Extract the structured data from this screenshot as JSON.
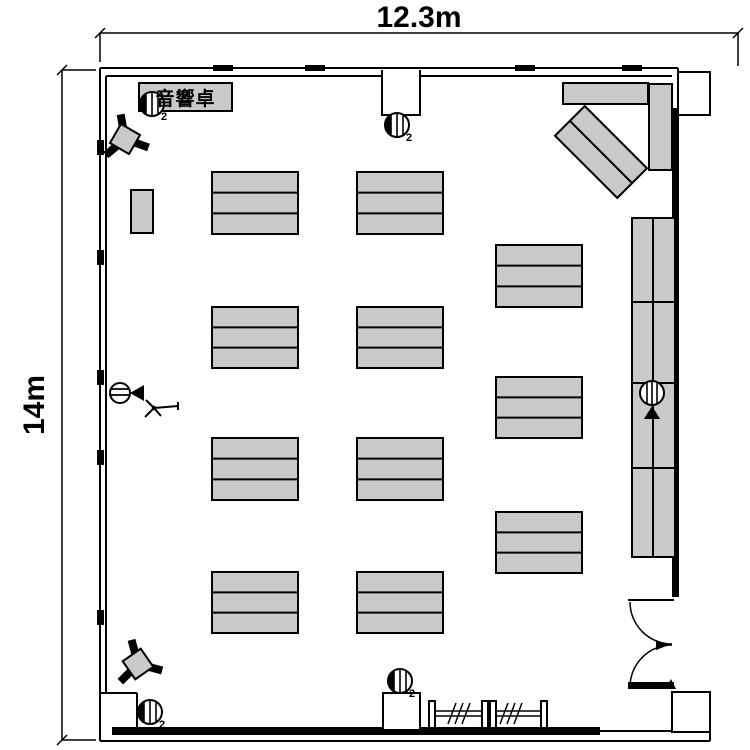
{
  "dimensions": {
    "width_label": "12.3m",
    "height_label": "14m"
  },
  "labels": {
    "audio_console": "音響卓"
  },
  "colors": {
    "table_fill": "#c9c9c9",
    "wall": "#000000",
    "background": "#ffffff"
  },
  "furniture": {
    "fill": "#c9c9c9",
    "stroke": "#000000",
    "table_groups": [
      {
        "x": 212,
        "y": 172,
        "w": 86,
        "h": 62,
        "rows": 3
      },
      {
        "x": 212,
        "y": 307,
        "w": 86,
        "h": 61,
        "rows": 3
      },
      {
        "x": 212,
        "y": 438,
        "w": 86,
        "h": 62,
        "rows": 3
      },
      {
        "x": 212,
        "y": 572,
        "w": 86,
        "h": 61,
        "rows": 3
      },
      {
        "x": 357,
        "y": 172,
        "w": 86,
        "h": 62,
        "rows": 3
      },
      {
        "x": 357,
        "y": 307,
        "w": 86,
        "h": 61,
        "rows": 3
      },
      {
        "x": 357,
        "y": 438,
        "w": 86,
        "h": 62,
        "rows": 3
      },
      {
        "x": 357,
        "y": 572,
        "w": 86,
        "h": 61,
        "rows": 3
      },
      {
        "x": 496,
        "y": 245,
        "w": 86,
        "h": 62,
        "rows": 3
      },
      {
        "x": 496,
        "y": 377,
        "w": 86,
        "h": 61,
        "rows": 3
      },
      {
        "x": 496,
        "y": 512,
        "w": 86,
        "h": 61,
        "rows": 3
      },
      {
        "x": 563,
        "y": 83,
        "w": 85,
        "h": 21,
        "rows": 1
      },
      {
        "x": 649,
        "y": 84,
        "w": 23,
        "h": 86,
        "rows": 1
      },
      {
        "x": 131,
        "y": 190,
        "w": 22,
        "h": 43,
        "rows": 1
      },
      {
        "x": 139,
        "y": 83,
        "w": 93,
        "h": 28,
        "rows": 1
      }
    ],
    "rotated_group": {
      "cx": 601,
      "cy": 152,
      "w": 88,
      "h": 42,
      "angle": 45,
      "rows": 2
    },
    "right_strip": {
      "x": 632,
      "y": 218,
      "w": 43,
      "h": 339,
      "col_divider": 21,
      "row_dividers": [
        84,
        165,
        250
      ]
    }
  },
  "symbols": [
    {
      "name": "speaker-icon",
      "type": "speaker",
      "x": 152,
      "y": 104,
      "label": "2"
    },
    {
      "name": "speaker-icon",
      "type": "speaker",
      "x": 397,
      "y": 125,
      "label": "2"
    },
    {
      "name": "speaker-icon",
      "type": "speaker",
      "x": 400,
      "y": 681,
      "label": "2"
    },
    {
      "name": "speaker-icon",
      "type": "speaker",
      "x": 150,
      "y": 712,
      "label": "2"
    },
    {
      "name": "projector-side-icon",
      "type": "camera-side",
      "x": 120,
      "y": 393
    },
    {
      "name": "projector-up-icon",
      "type": "camera-up",
      "x": 652,
      "y": 393
    },
    {
      "name": "tripod-icon",
      "type": "tripod",
      "x": 125,
      "y": 139,
      "rot": -15
    },
    {
      "name": "tripod-icon",
      "type": "tripod",
      "x": 138,
      "y": 664,
      "rot": 100
    },
    {
      "name": "mic-stand-icon",
      "type": "stand",
      "x": 154,
      "y": 408
    }
  ]
}
